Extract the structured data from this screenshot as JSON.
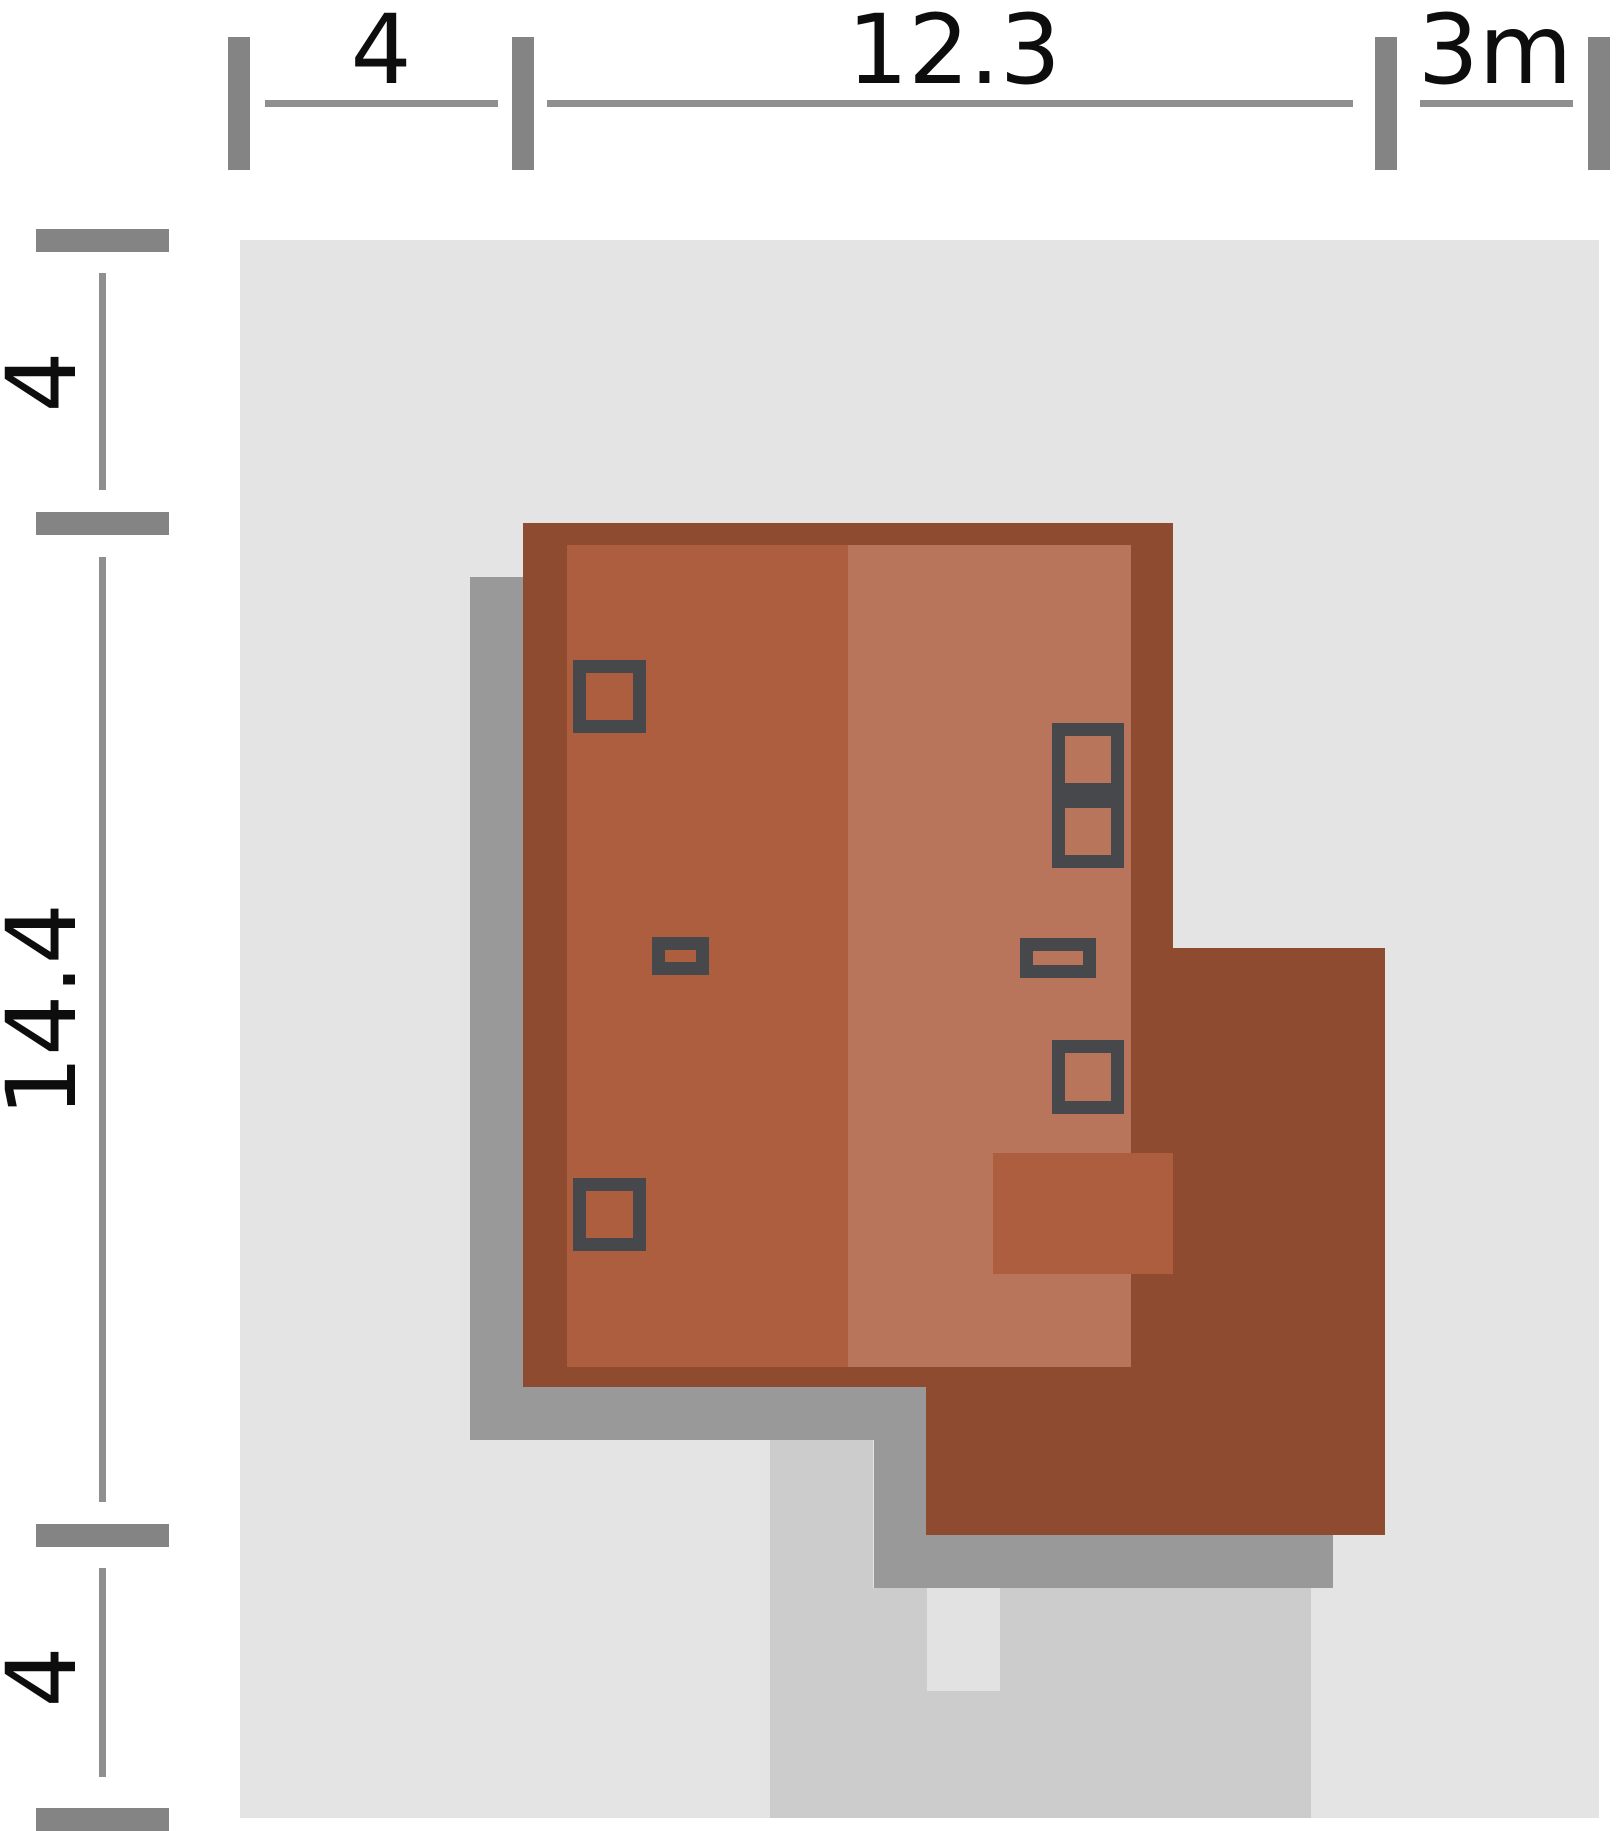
{
  "plan": {
    "type": "house-site-plan",
    "plot_width_m": 19.3,
    "plot_depth_m": 22.4
  },
  "dimensions": {
    "top": [
      {
        "label": "4"
      },
      {
        "label": "12.3"
      },
      {
        "label": "3m"
      }
    ],
    "left": [
      {
        "label": "4"
      },
      {
        "label": "14.4"
      },
      {
        "label": "4"
      }
    ]
  },
  "colors": {
    "background": "#ffffff",
    "plot": "#e4e4e4",
    "shadow": "#999999",
    "driveway": "#cccccc",
    "entry_pad": "#e2e2e2",
    "roof_edge": "#8f4b2f",
    "roof_left": "#ac5e3e",
    "roof_right": "#b8755c",
    "low_roof": "#ac5e3e",
    "chimney_outline": "#46484b",
    "dim_tick": "#848484",
    "dim_line": "#8f8f8f",
    "dim_text": "#0d0d0d"
  }
}
